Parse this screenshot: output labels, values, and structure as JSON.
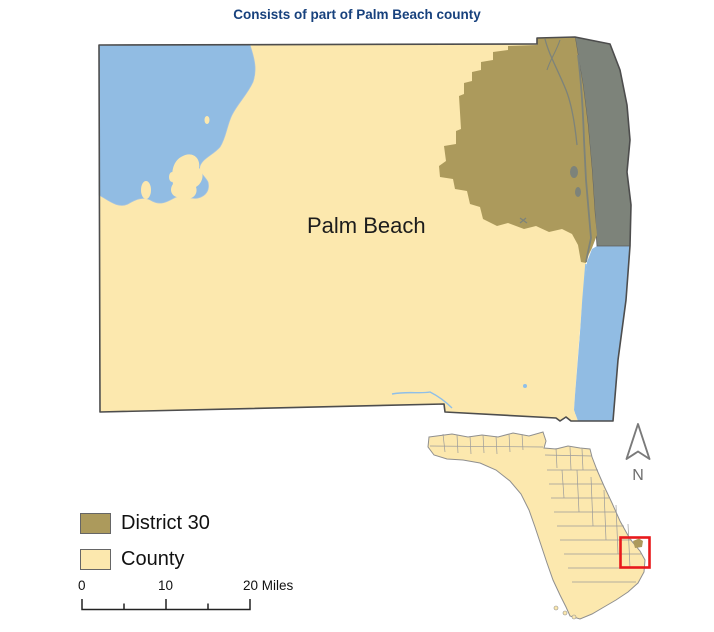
{
  "title": {
    "text": "Consists of part of Palm Beach county"
  },
  "map": {
    "county_label": "Palm Beach",
    "compass_label": "N"
  },
  "legend": {
    "items": [
      {
        "label": "District 30",
        "color": "#AC9A5C"
      },
      {
        "label": "County",
        "color": "#FCE8AE"
      }
    ]
  },
  "scale_bar": {
    "labels": [
      "0",
      "10",
      "20 Miles"
    ]
  },
  "colors": {
    "title_text": "#17417D",
    "district": "#AC9A5C",
    "county": "#FCE8AE",
    "water": "#91BCE3",
    "coastal_gray": "#7D837A",
    "outline": "#4D4D4D",
    "extent_box": "#E8191C",
    "inset_border": "#8F8F8F"
  }
}
